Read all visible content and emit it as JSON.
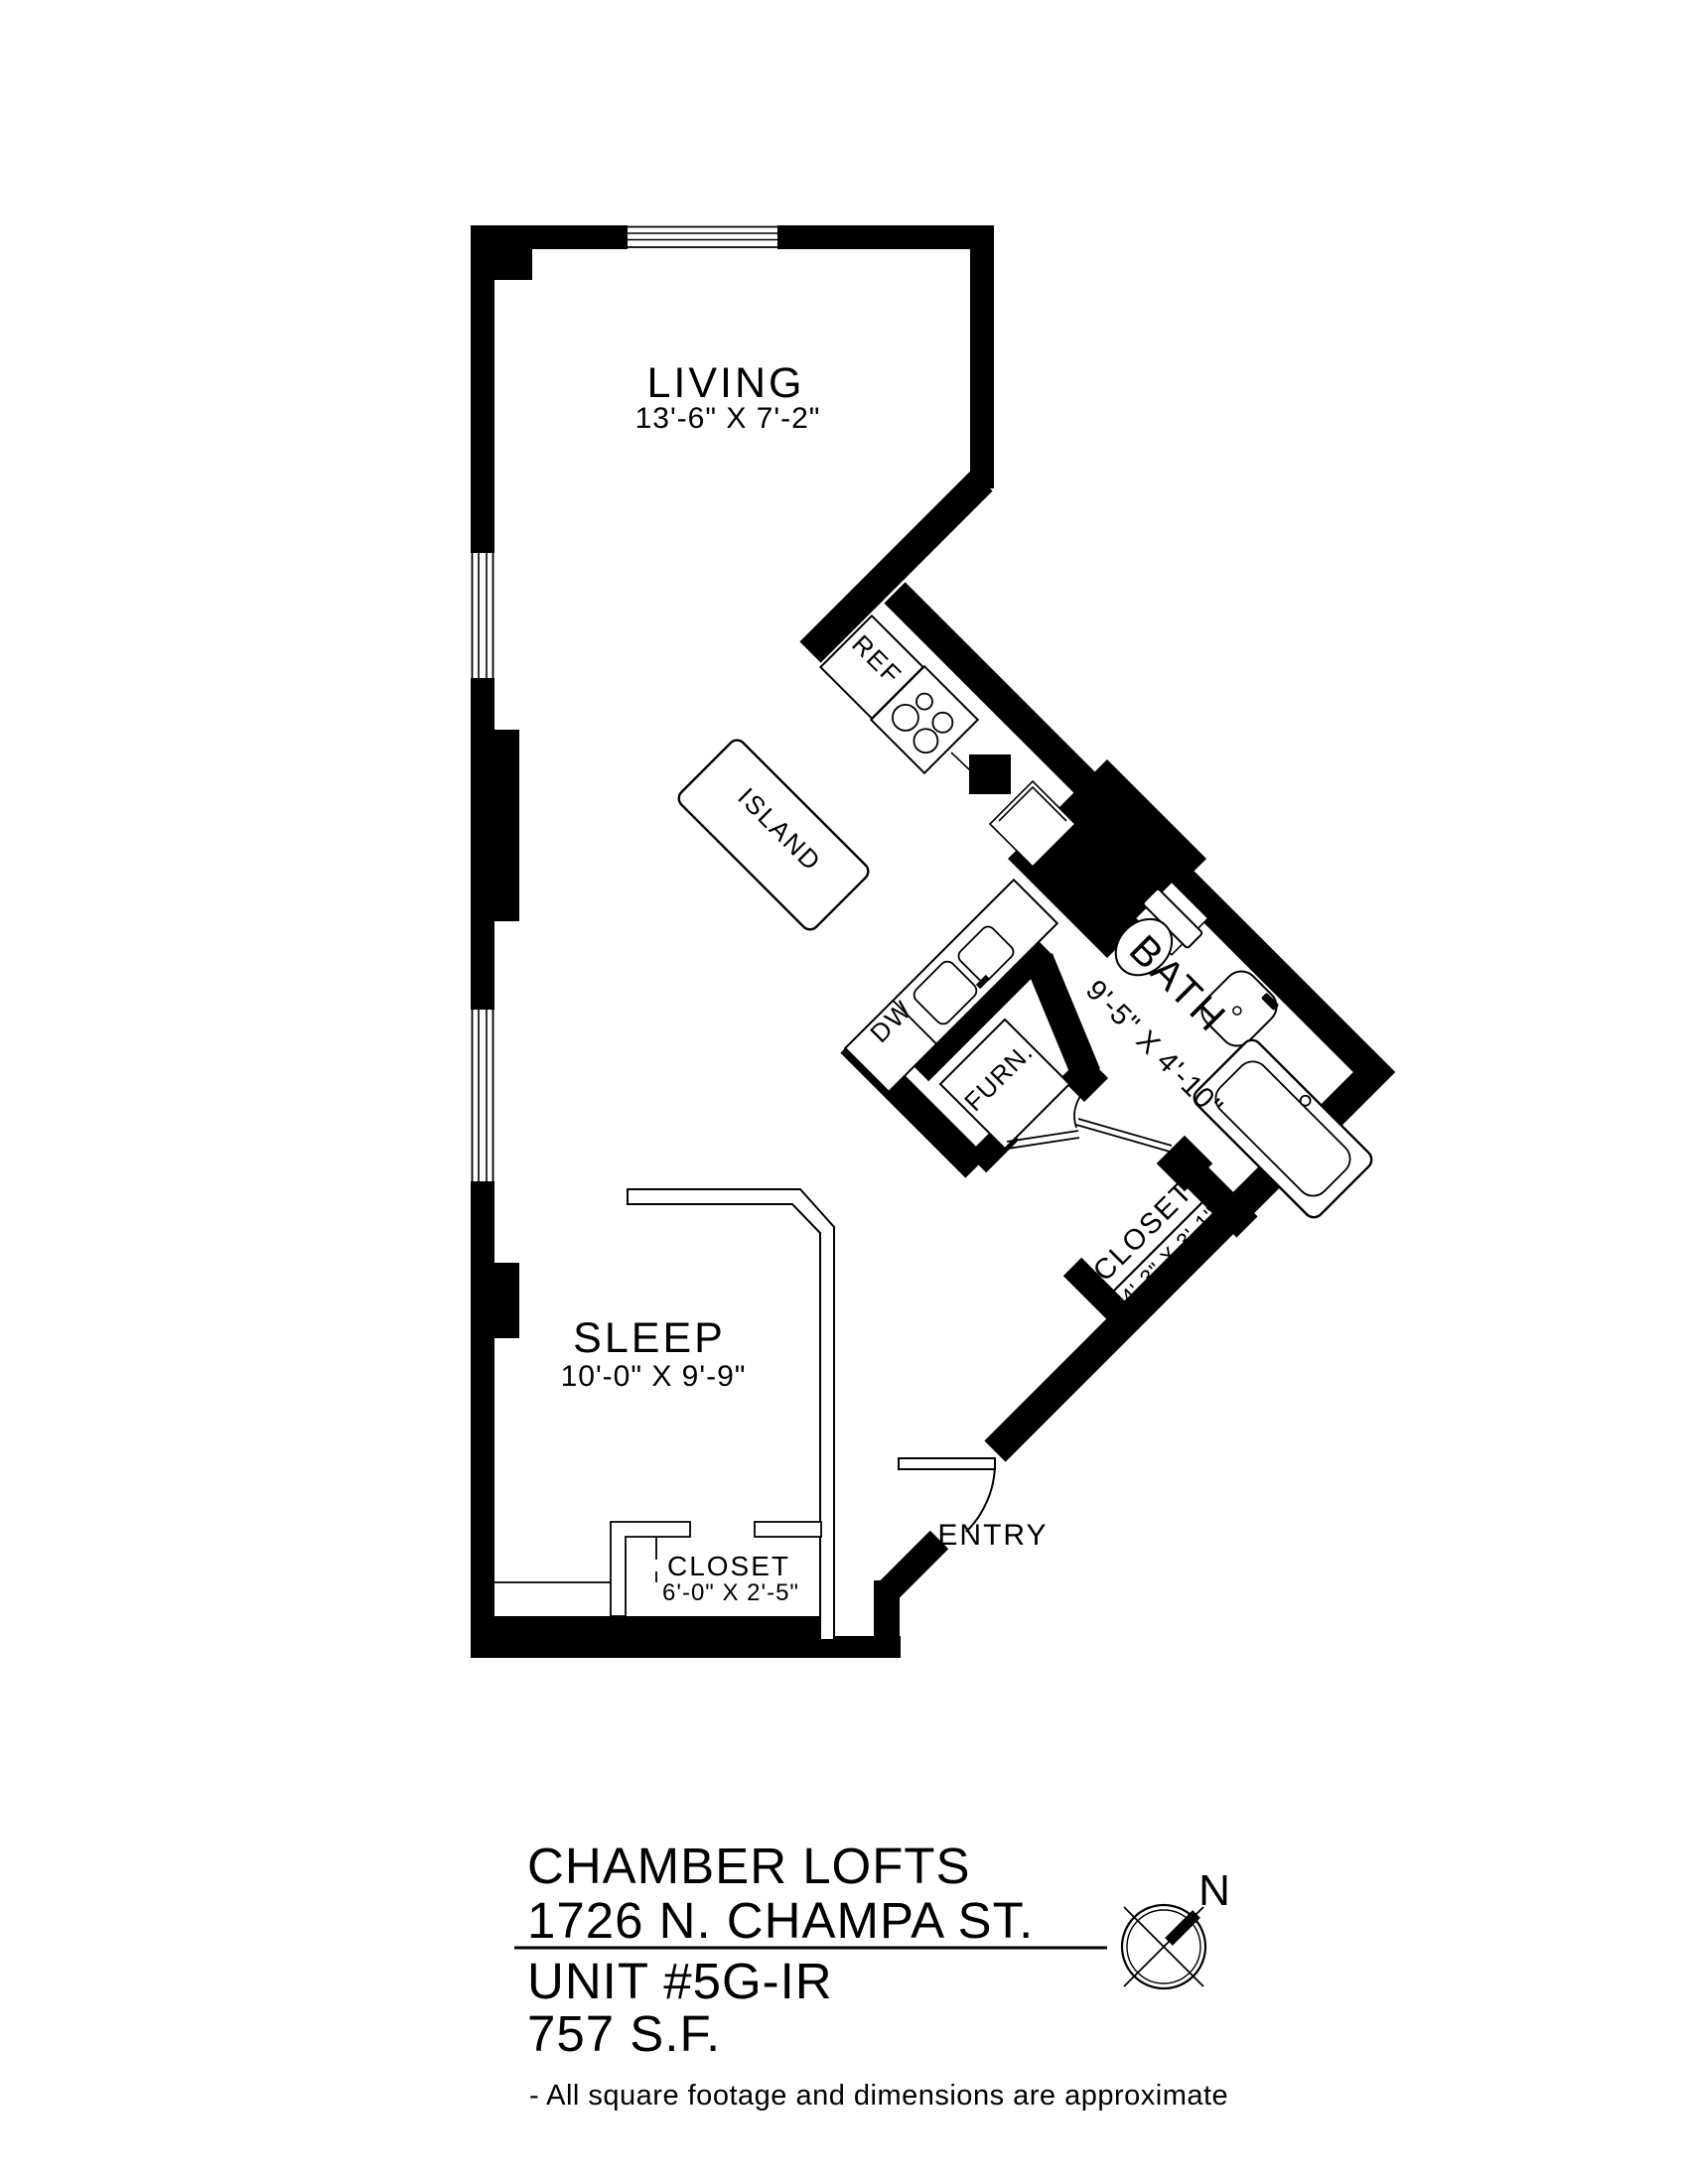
{
  "plan": {
    "rooms": {
      "living": {
        "name": "LIVING",
        "dims": "13'-6\" X 7'-2\""
      },
      "sleep": {
        "name": "SLEEP",
        "dims": "10'-0\" X 9'-9\""
      },
      "bath": {
        "name": "BATH",
        "dims": "9'-5\" X 4'-10\""
      },
      "hall_closet": {
        "name": "CLOSET",
        "dims": "4'-3\" X 3'-1\""
      },
      "sleep_closet": {
        "name": "CLOSET",
        "dims": "6'-0\" X 2'-5\""
      },
      "entry": {
        "name": "ENTRY"
      }
    },
    "fixtures": {
      "island": "ISLAND",
      "refrigerator": "REF",
      "dishwasher": "DW",
      "furnace": "FURN."
    }
  },
  "footer": {
    "building": "CHAMBER LOFTS",
    "address": "1726 N. CHAMPA ST.",
    "unit": "UNIT #5G-IR",
    "area": "757 S.F.",
    "disclaimer": "- All square footage and dimensions are approximate"
  },
  "compass": {
    "north_label": "N"
  },
  "colors": {
    "ink": "#000000",
    "background": "#ffffff"
  }
}
